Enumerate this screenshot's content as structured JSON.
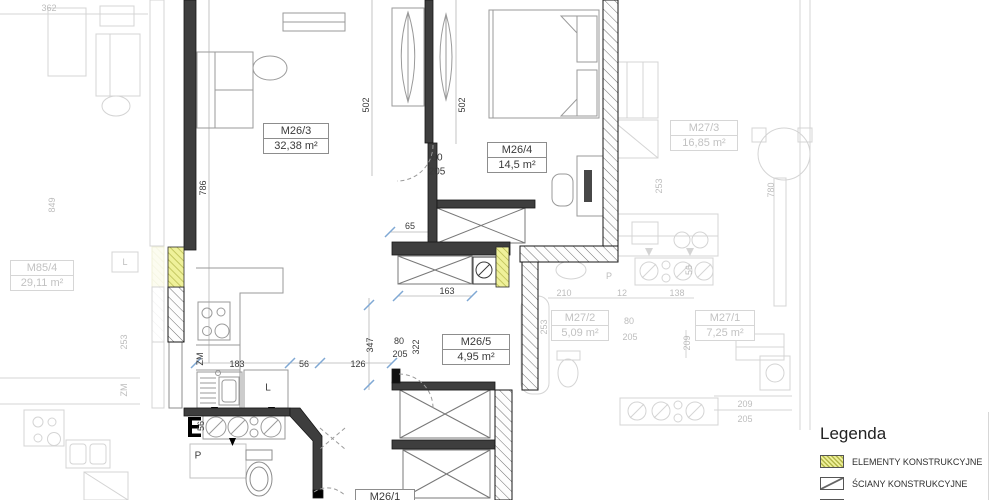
{
  "plan": {
    "rooms": {
      "m26_3": {
        "name": "M26/3",
        "area": "32,38 m²"
      },
      "m26_4": {
        "name": "M26/4",
        "area": "14,5 m²"
      },
      "m26_5": {
        "name": "M26/5",
        "area": "4,95 m²"
      },
      "m26_1": {
        "name": "M26/1"
      },
      "m27_3": {
        "name": "M27/3",
        "area": "16,85 m²"
      },
      "m27_2": {
        "name": "M27/2",
        "area": "5,09 m²"
      },
      "m27_1": {
        "name": "M27/1",
        "area": "7,25 m²"
      },
      "m85_4": {
        "name": "M85/4",
        "area": "29,11 m²"
      }
    },
    "dimensions": {
      "d362": "362",
      "d786": "786",
      "d849": "849",
      "d502a": "502",
      "d502b": "502",
      "d80_door1": "80",
      "d205_door1": "205",
      "d65": "65",
      "d163": "163",
      "d347": "347",
      "d322": "322",
      "d80_door2": "80",
      "d205_door2": "205",
      "d183": "183",
      "d56a": "56",
      "d126": "126",
      "d56_shaft": "56",
      "d210": "210",
      "d12": "12",
      "d138": "138",
      "d253a": "253",
      "d253b": "253",
      "d253c": "253",
      "d780": "780",
      "d209a": "209",
      "d80_door3": "80",
      "d205_door3": "205",
      "d56b": "56",
      "d209b": "209",
      "d205b": "205"
    },
    "appliances": {
      "zm_main": "ZM",
      "l_main": "L",
      "p_main": "P",
      "zm_left": "ZM",
      "l_left": "L",
      "p_right": "P"
    }
  },
  "legend": {
    "title": "Legenda",
    "items": [
      {
        "label": "ELEMENTY KONSTRUKCYJNE"
      },
      {
        "label": "ŚCIANY KONSTRUKCYJNE"
      },
      {
        "label": "ŚCIANY DZIAŁOWE",
        "note": "(możliwość"
      }
    ]
  },
  "colors": {
    "wall": "#3e3e3e",
    "accent_yellow": "#eff19a",
    "hatch_line": "#6a6a6a",
    "tick_blue": "#7fa8d4",
    "faded": "#bdbdbd"
  }
}
